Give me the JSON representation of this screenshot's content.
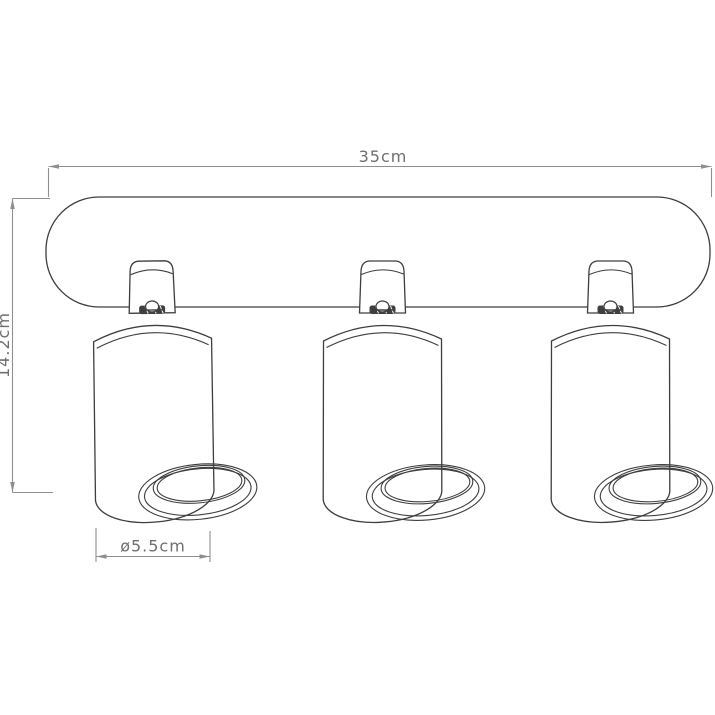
{
  "diagram": {
    "title": "ceiling spotlight dimension drawing",
    "dimensions": {
      "width": {
        "label": "35cm"
      },
      "height": {
        "label": "14.2cm"
      },
      "diameter": {
        "label": "ø5.5cm"
      }
    },
    "parts": {
      "spotlight_count": 3
    },
    "colors": {
      "background": "#ffffff",
      "fixture_outline": "#3e3e3e",
      "dimension_line": "#8f8f8f",
      "dimension_text": "#6f6f6f",
      "joint_fill": "#3f3f3f"
    }
  }
}
